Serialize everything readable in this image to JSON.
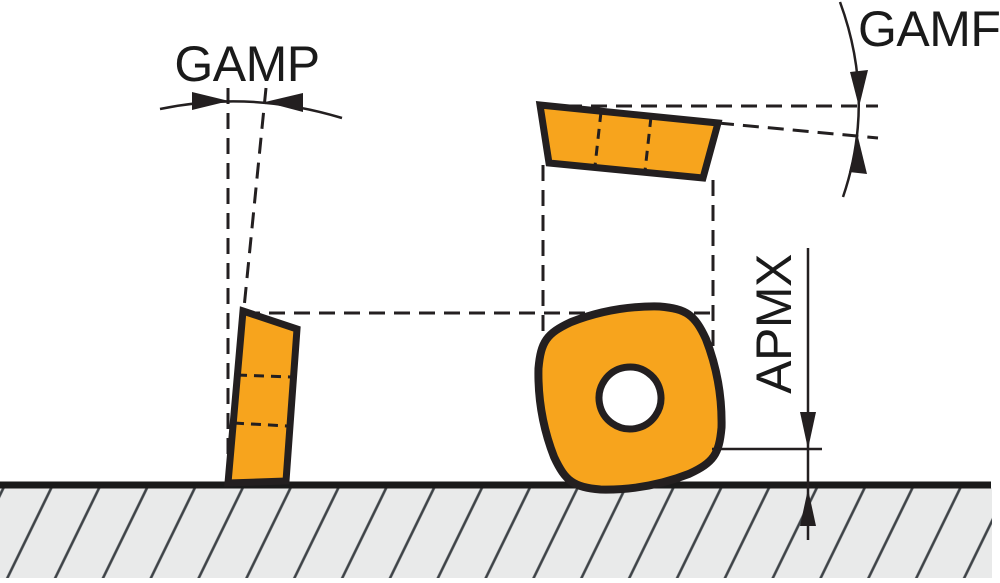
{
  "diagram": {
    "labels": {
      "gamp": "GAMP",
      "gamf": "GAMF",
      "apmx": "APMX"
    },
    "colors": {
      "insert_fill": "#F7A41D",
      "outline": "#231F20",
      "ground_fill": "#E9EAEA",
      "hatch_line": "#3E4347",
      "background": "#FFFFFF"
    }
  }
}
